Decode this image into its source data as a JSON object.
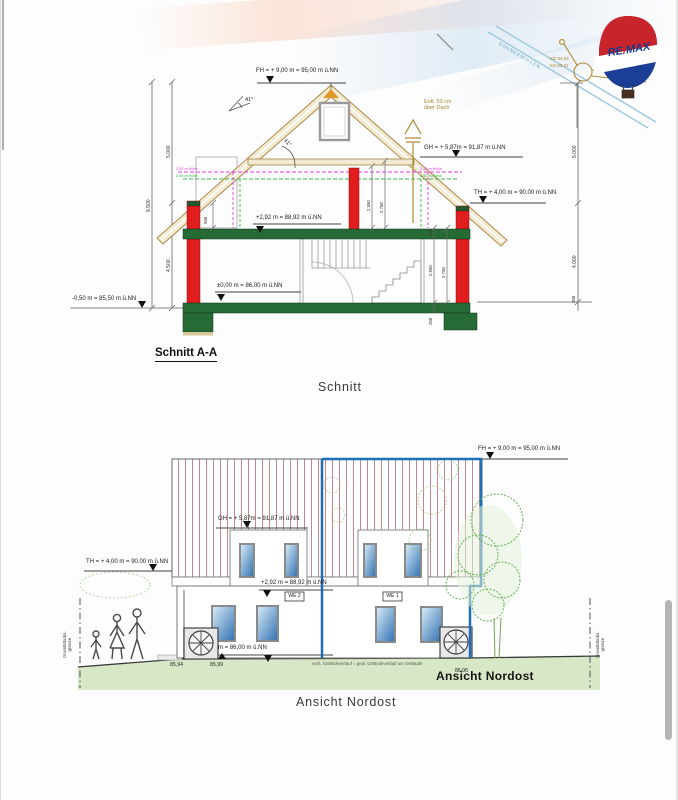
{
  "logo": {
    "part1": "RE",
    "slash": "/",
    "part2": "MAX"
  },
  "utilities": {
    "pipe_label": "B DN 300 8,00 m 1,5 %",
    "kd_label": "KD 84.04",
    "ks_label": "KS 82.31"
  },
  "section": {
    "title": "Schnitt A-A",
    "caption": "Schnitt",
    "levels": {
      "fh": "FH = + 9,00 m = 95,00 m ü.NN",
      "gh": "GH = + 5,87m = 91,87 m ü.NN",
      "th": "TH = + 4,00 m = 90,00 m ü.NN",
      "og": "+2,92 m = 88,92 m ü.NN",
      "eg": "±0,00 m = 86,00 m ü.NN",
      "base": "-0,50 m = 85,50 m ü.NN"
    },
    "vent_note": "Entl. 50 cm\nüber Dach",
    "roof_angle": "41°",
    "dims": {
      "total": "9.500",
      "upper": "5.000",
      "lower": "4.500",
      "right_upper": "5.000",
      "right_lower": "4.000",
      "right_base": "200",
      "knee": "960",
      "attic_clear": "2.550",
      "attic_top": "2.750",
      "eg_sill": "220",
      "eg_clear": "2.550",
      "eg_top": "2.750",
      "slab": "250"
    },
    "clearance": {
      "magenta": "2,30 m Höhe",
      "green": "2,00 m Höhe"
    }
  },
  "elevation": {
    "grass_title": "Ansicht Nordost",
    "caption": "Ansicht Nordost",
    "levels": {
      "fh": "FH = + 9,00 m = 95,00 m ü.NN",
      "gh": "GH = + 5,87m = 91,87 m ü.NN",
      "th": "TH = + 4,00 m = 90,00 m ü.NN",
      "og": "+2,92 m = 88,92 m ü.NN",
      "eg_partial": "m = 86,00 m ü.NN"
    },
    "units": {
      "left": "WE 2",
      "right": "WE 1"
    },
    "spots": {
      "s1": "85,94",
      "s2": "85,99",
      "s3": "86,06"
    },
    "ground_note": "vorh. Geländeverlauf = gepl. Geländeverlauf am Gebäude",
    "boundary": "Grundstücks-\ngrenze"
  },
  "colors": {
    "unit_outline_blue": "#1d6fb5",
    "wall_red": "#e11d1d",
    "slab_green": "#266b36",
    "wood_tan": "#a6813e",
    "clearance_magenta": "#e53ae5",
    "clearance_green": "#3bb54a",
    "grass": "#d8e8c6",
    "brand_navy": "#153a8f",
    "brand_red": "#c8242c"
  }
}
